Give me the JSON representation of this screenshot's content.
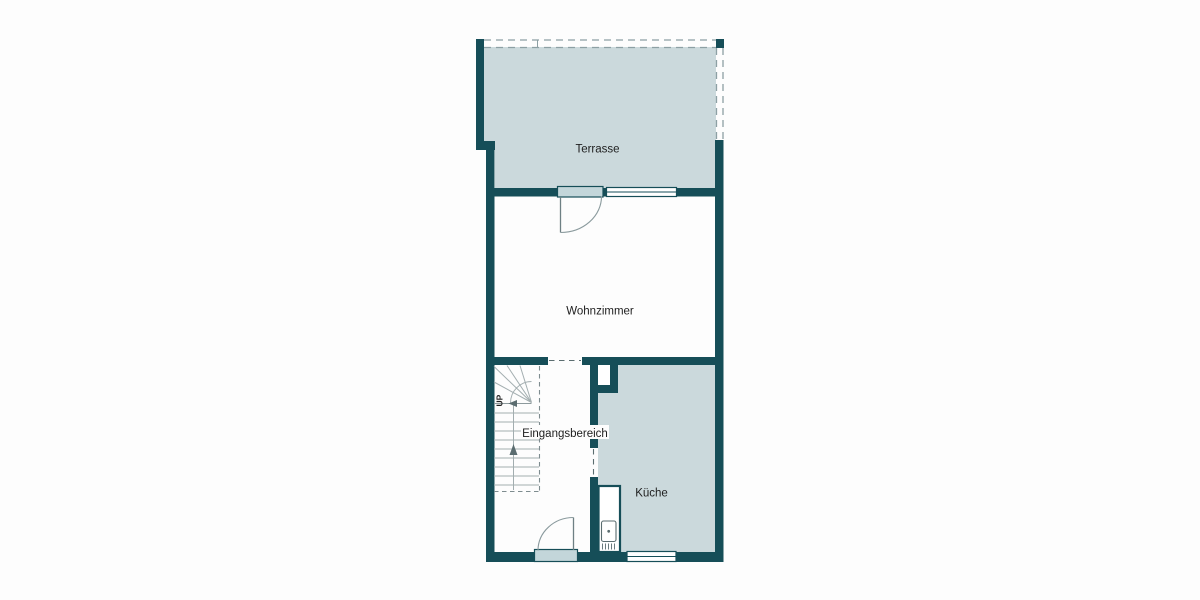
{
  "plan": {
    "rooms": {
      "terrasse": {
        "label": "Terrasse"
      },
      "wohnzimmer": {
        "label": "Wohnzimmer"
      },
      "eingangsbereich": {
        "label": "Eingangsbereich"
      },
      "kueche": {
        "label": "Küche"
      }
    },
    "stairs": {
      "up_label": "UP"
    },
    "colors": {
      "wall": "#164e58",
      "room_fill": "#cbd9dc",
      "door_fill": "#c3d6da",
      "background": "#fdfdfd",
      "detail_gray": "#5b6d70",
      "text": "#1e1e1e"
    }
  }
}
